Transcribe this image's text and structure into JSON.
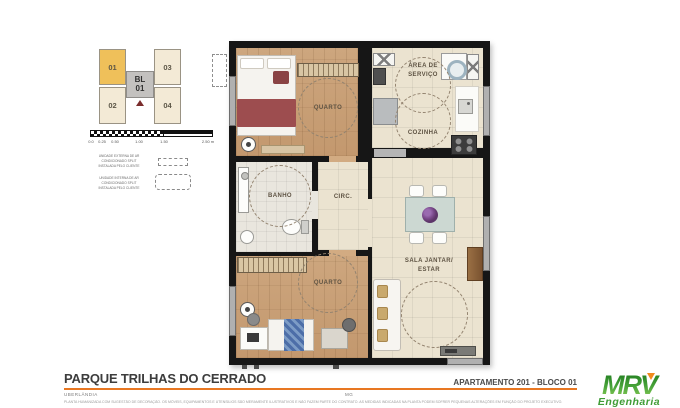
{
  "site_key": {
    "units": [
      {
        "id": "01",
        "highlighted": true
      },
      {
        "id": "02",
        "highlighted": false
      },
      {
        "id": "03",
        "highlighted": false
      },
      {
        "id": "04",
        "highlighted": false
      }
    ],
    "block": {
      "line1": "BL",
      "line2": "01"
    }
  },
  "scale_bar": {
    "ticks": [
      "0.0",
      "0.25",
      "0.50",
      "1.00",
      "1.50",
      "2.50 m"
    ]
  },
  "legend": {
    "items": [
      {
        "label": "UNIDADE EXTERNA DE AR CONDICIONADO SPLIT INSTALADA PELO CLIENTE"
      },
      {
        "label": "UNIDADE INTERNA DE AR CONDICIONADO SPLIT INSTALADA PELO CLIENTE"
      }
    ]
  },
  "plan": {
    "labels": {
      "quarto1": "QUARTO",
      "area_servico_l1": "ÁREA DE",
      "area_servico_l2": "SERVIÇO",
      "cozinha": "COZINHA",
      "banho": "BANHO",
      "circ": "CIRC.",
      "quarto2": "QUARTO",
      "sala_l1": "SALA JANTAR/",
      "sala_l2": "ESTAR"
    }
  },
  "footer": {
    "project": "PARQUE TRILHAS DO CERRADO",
    "city": "UBERLÂNDIA",
    "state": "MG",
    "apartment": "APARTAMENTO 201 - BLOCO 01",
    "disclaimer": "PLANTA HUMANIZADA COM SUGESTÃO DE DECORAÇÃO. OS MÓVEIS, EQUIPAMENTOS E UTENSÍLIOS SÃO MERAMENTE ILUSTRATIVOS E NÃO FAZEM PARTE DO CONTRATO. AS MEDIDAS INDICADAS NA PLANTA PODEM SOFRER PEQUENAS ALTERAÇÕES EM FUNÇÃO DO PROJETO EXECUTIVO.",
    "logo": {
      "brand": "MRV",
      "sub": "Engenharia"
    }
  },
  "colors": {
    "accent_orange": "#e87722",
    "brand_green": "#3f9c35",
    "unit_highlight": "#efc05a",
    "unit_default": "#f3ead6",
    "wall": "#161616",
    "wood_floor": "#c8a178",
    "tile_floor": "#ebe3d0",
    "blanket_red": "#9d4d4f"
  }
}
